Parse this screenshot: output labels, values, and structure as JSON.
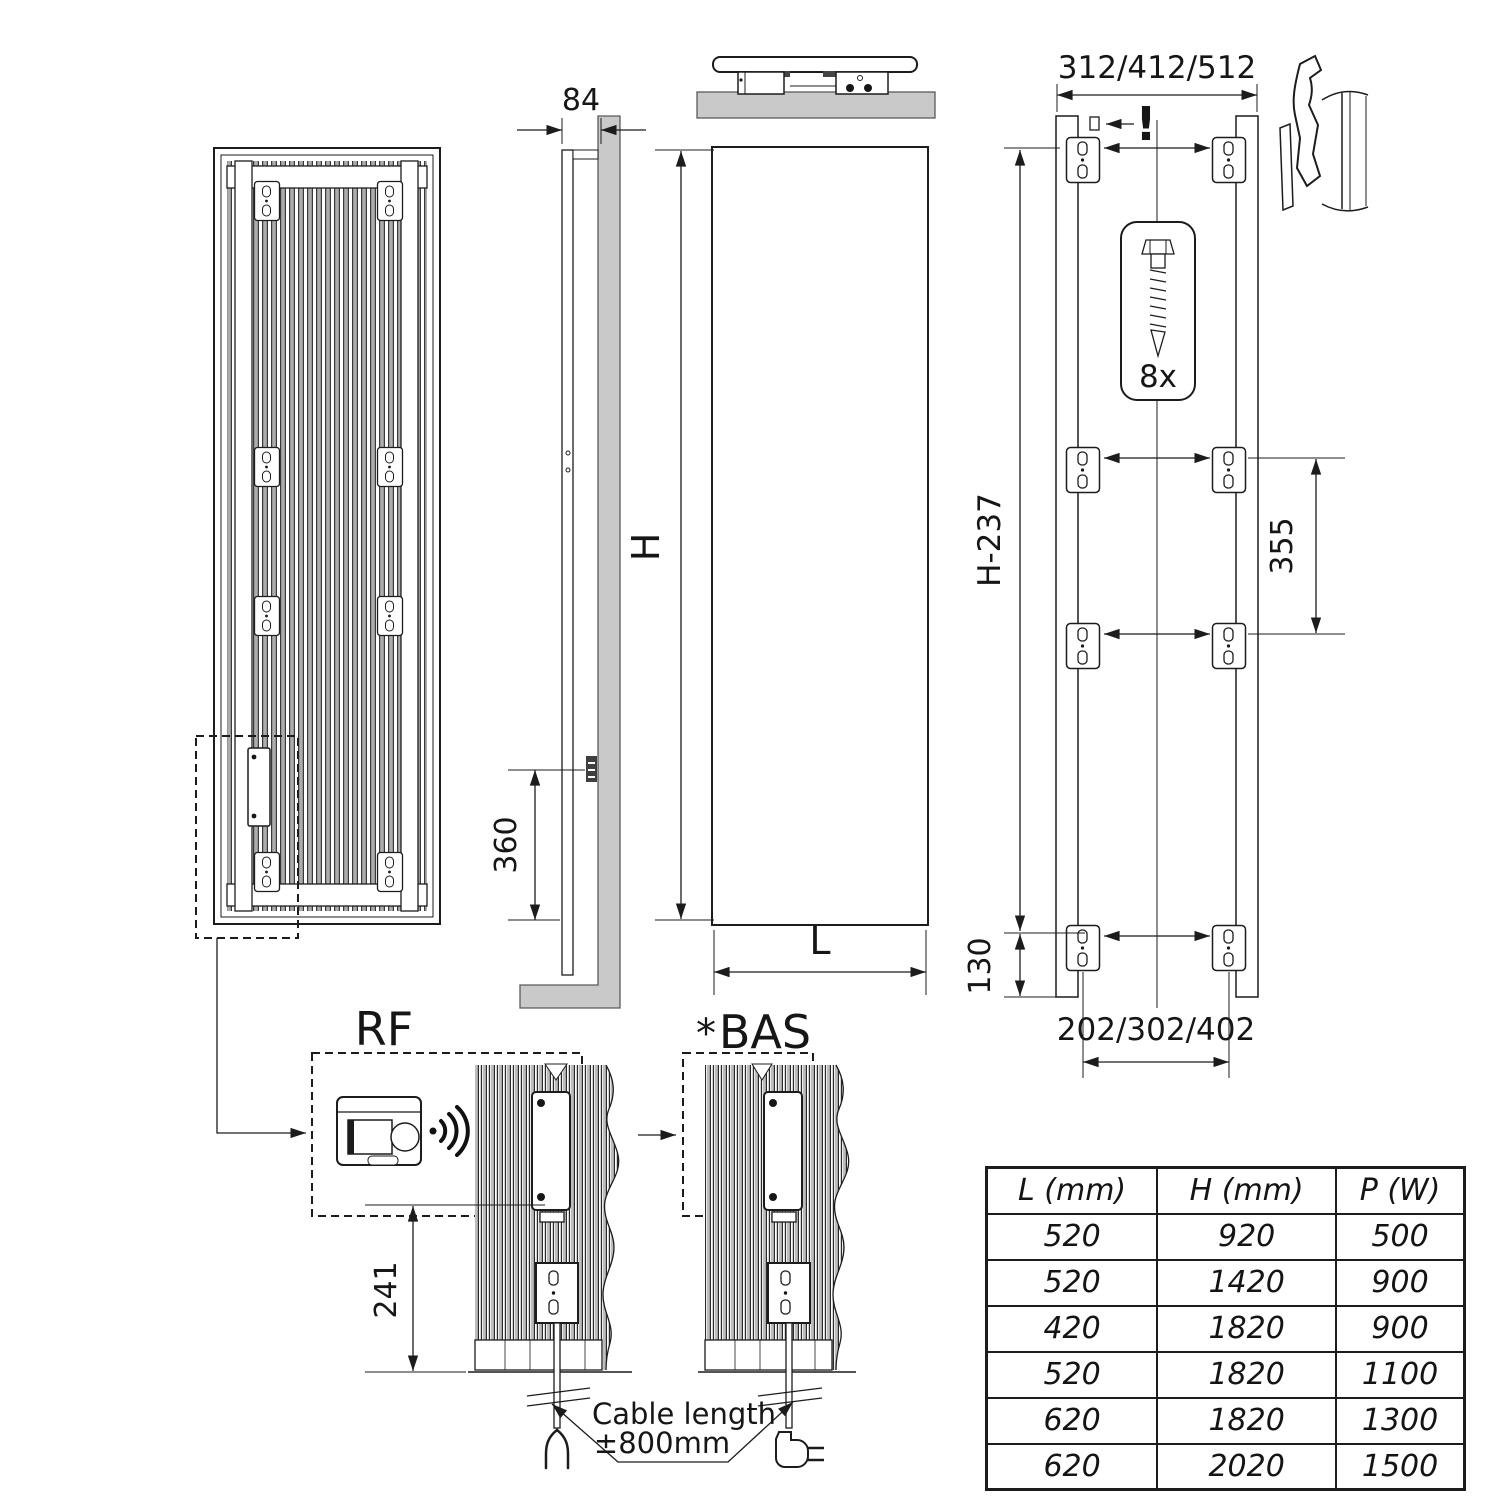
{
  "colors": {
    "line": "#1c1c1c",
    "wall_fill": "#c9c9c9",
    "fin_fill": "#adadad",
    "background": "#ffffff"
  },
  "dimensions": {
    "depth": "84",
    "height_label": "H",
    "width_label": "L",
    "bottom_to_connector": "360",
    "top_bracket_width": "312/412/512",
    "bracket_vertical_span": "H-237",
    "mid_bracket_spacing": "355",
    "bottom_bracket_offset": "130",
    "bottom_bracket_width": "202/302/402",
    "control_height": "241",
    "warning_mark": "!",
    "screw_count": "8x"
  },
  "details": {
    "rf_label": "RF",
    "bas_star": "*",
    "bas_label": "BAS",
    "cable_note_line1": "Cable length",
    "cable_note_line2": "±800mm"
  },
  "spec_table": {
    "headers": [
      "L (mm)",
      "H (mm)",
      "P (W)"
    ],
    "rows": [
      [
        "520",
        "920",
        "500"
      ],
      [
        "520",
        "1420",
        "900"
      ],
      [
        "420",
        "1820",
        "900"
      ],
      [
        "520",
        "1820",
        "1100"
      ],
      [
        "620",
        "1820",
        "1300"
      ],
      [
        "620",
        "2020",
        "1500"
      ]
    ]
  }
}
